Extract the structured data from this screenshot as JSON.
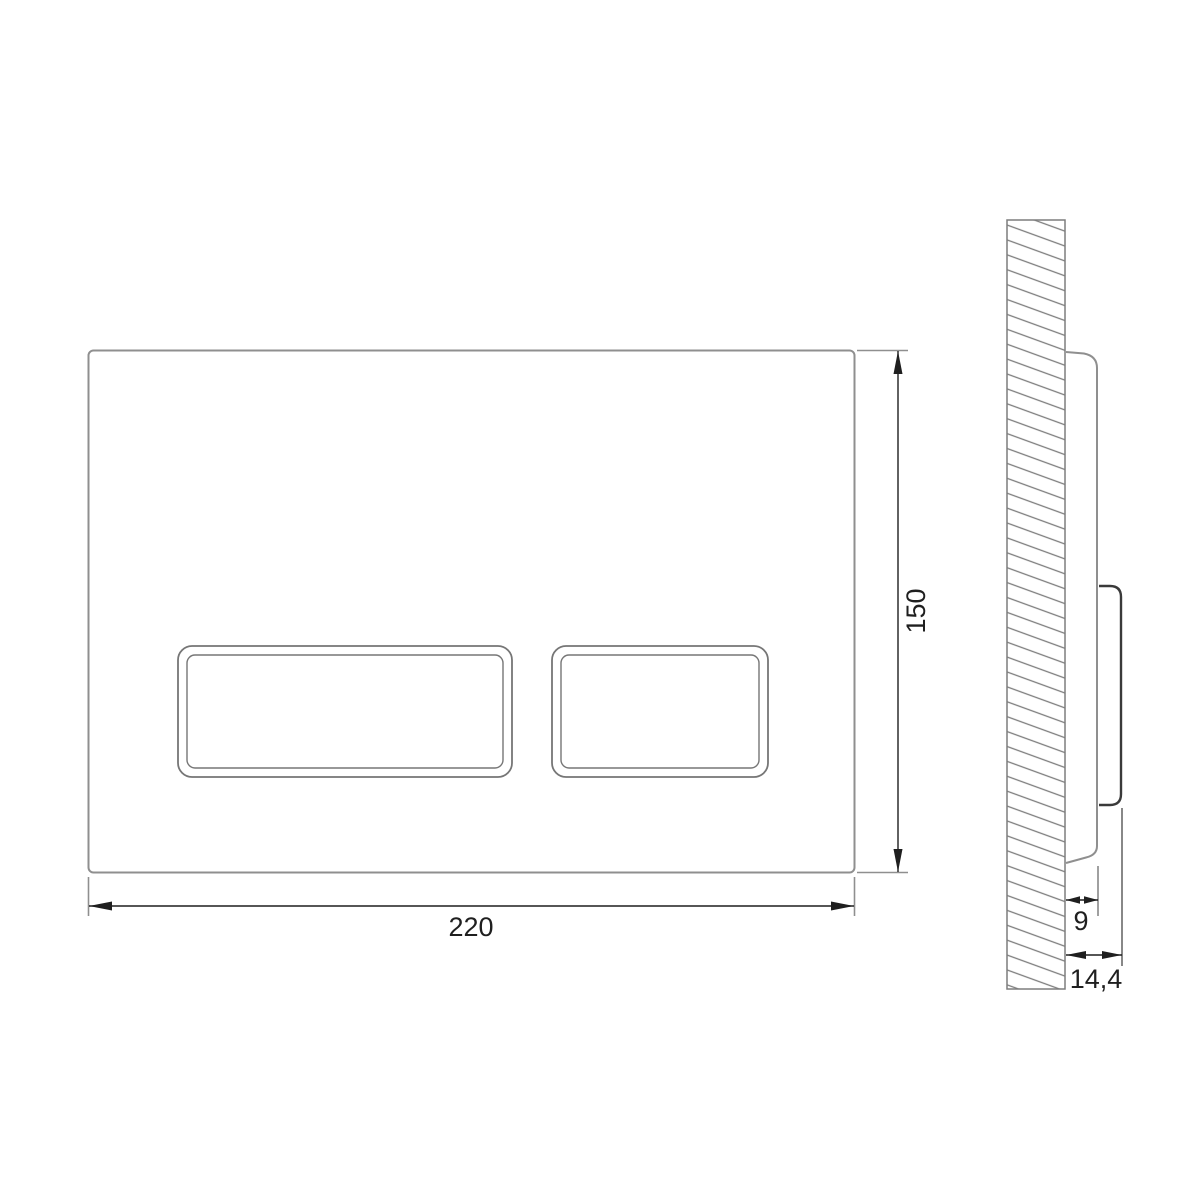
{
  "drawing": {
    "background": "#ffffff",
    "line_colors": {
      "plate_outline": "#8f8f8f",
      "button_outline": "#767676",
      "wall_hatch": "#7d7d7d",
      "dimension": "#1f1f1f",
      "side_button_profile": "#3a3a3a"
    },
    "front_view": {
      "width_label": "220",
      "height_label": "150"
    },
    "side_view": {
      "plate_depth_label": "9",
      "overall_depth_label": "14,4"
    }
  }
}
